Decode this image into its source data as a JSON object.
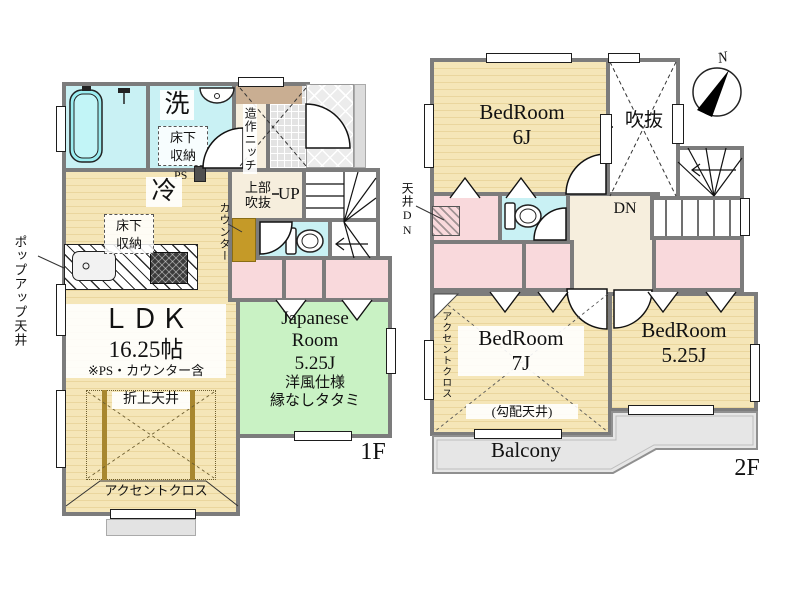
{
  "floor1": {
    "floor_label": "1F",
    "laundry": "洗",
    "underfloor_storage_top": "床下収納",
    "ps": "PS",
    "fridge": "冷",
    "underfloor_storage_ldk": "床下収納",
    "popup_ceiling": "ポップアップ天井",
    "counter": "カウンター",
    "niche": "造作ニッチ",
    "upper_void_line1": "上部",
    "upper_void_line2": "吹抜",
    "up": "UP",
    "ldk_name": "ＬＤＫ",
    "ldk_size": "16.25帖",
    "ldk_note": "※PS・カウンター含",
    "coffered_ceiling": "折上天井",
    "accent_cloth": "アクセントクロス",
    "jr_line1": "Japanese",
    "jr_line2": "Room",
    "jr_size": "5.25J",
    "jr_note1": "洋風仕様",
    "jr_note2": "縁なしタタミ"
  },
  "floor2": {
    "floor_label": "2F",
    "bedroom6_name": "BedRoom",
    "bedroom6_size": "6J",
    "void": "吹抜",
    "ceiling_dn": "天井DN",
    "dn": "DN",
    "bedroom7_name": "BedRoom",
    "bedroom7_size": "7J",
    "bedroom7_note": "(勾配天井)",
    "accent_cloth": "アクセントクロス",
    "bedroom525_name": "BedRoom",
    "bedroom525_size": "5.25J",
    "balcony": "Balcony",
    "compass_north": "N"
  },
  "colors": {
    "wall": "#7c7c7c",
    "room_tan": "#f5e6b8",
    "water_cyan": "#c9f1f4",
    "closet_pink": "#f9d9dc",
    "tatami_green": "#c9f2c4",
    "hall_beige": "#f6eedd",
    "balcony_gray": "#e6e6e6",
    "counter_mustard": "#c59a28"
  }
}
